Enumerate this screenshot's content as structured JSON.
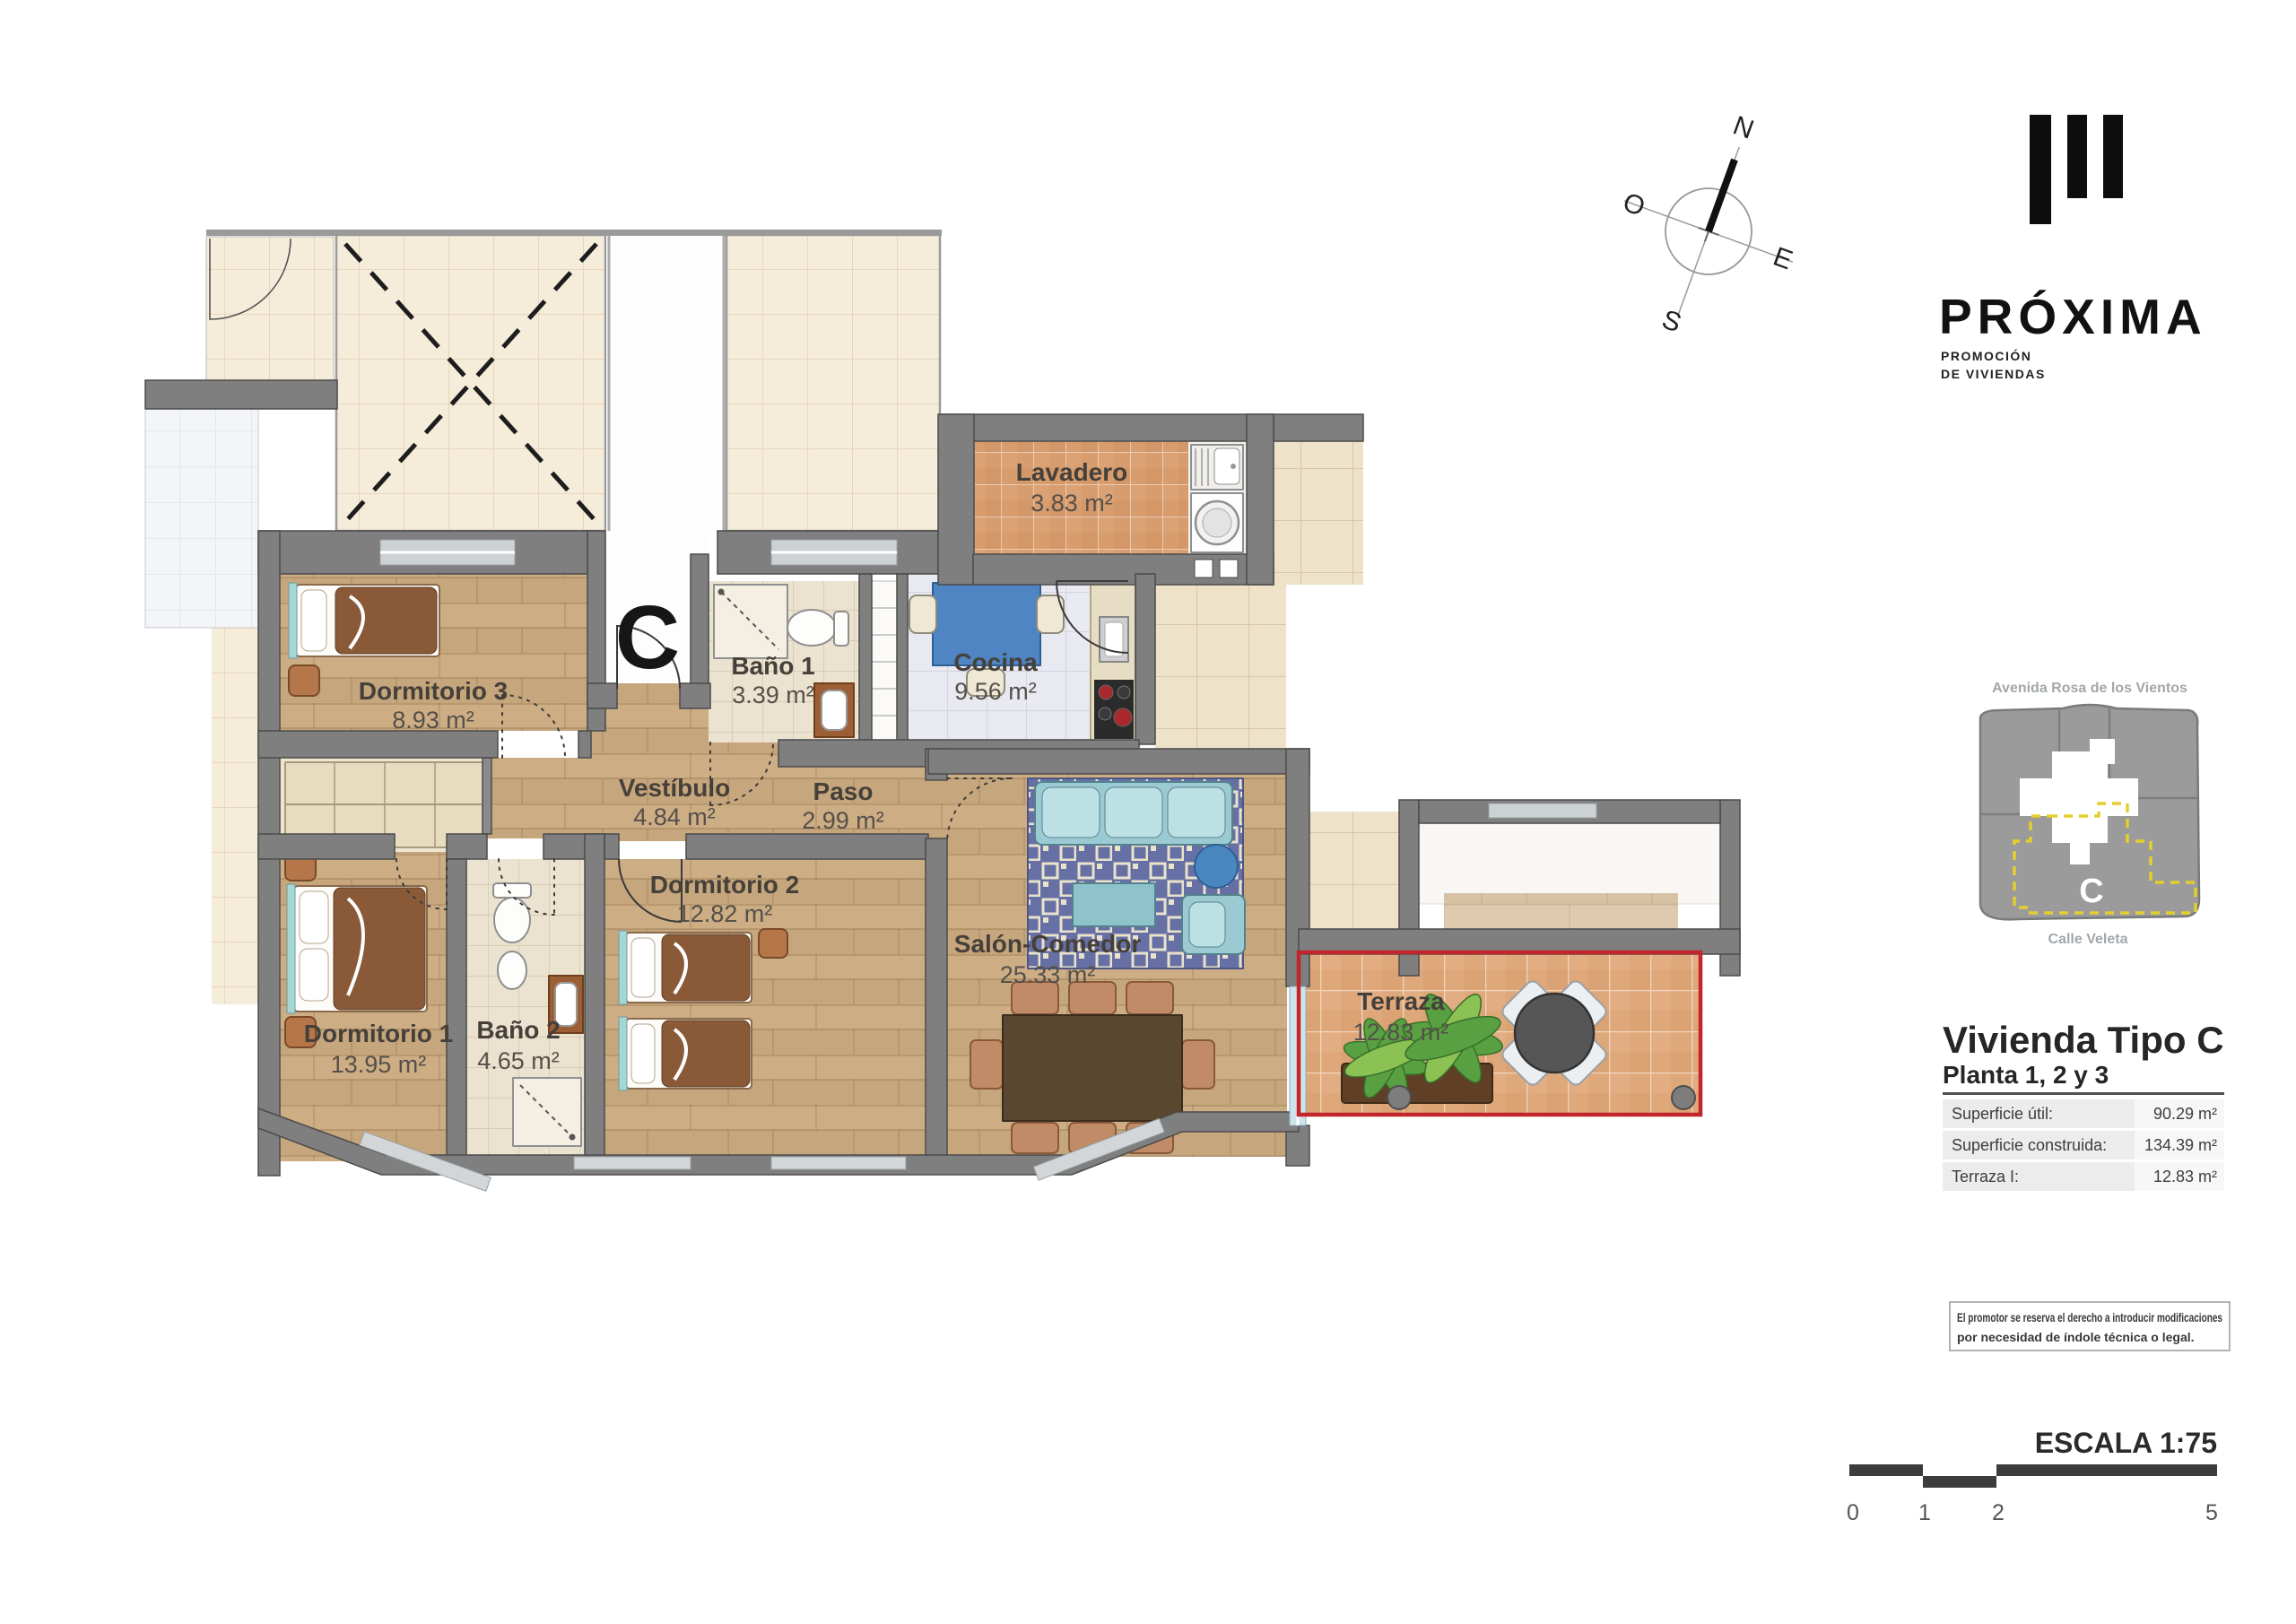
{
  "plan": {
    "unit_letter": "C",
    "rooms": [
      {
        "name": "Dormitorio 3",
        "area": "8.93 m²"
      },
      {
        "name": "Vestíbulo",
        "area": "4.84 m²"
      },
      {
        "name": "Paso",
        "area": "2.99 m²"
      },
      {
        "name": "Baño 1",
        "area": "3.39 m²"
      },
      {
        "name": "Cocina",
        "area": "9.56 m²"
      },
      {
        "name": "Lavadero",
        "area": "3.83 m²"
      },
      {
        "name": "Dormitorio 1",
        "area": "13.95 m²"
      },
      {
        "name": "Baño 2",
        "area": "4.65 m²"
      },
      {
        "name": "Dormitorio 2",
        "area": "12.82 m²"
      },
      {
        "name": "Salón-Comedor",
        "area": "25.33 m²"
      },
      {
        "name": "Terraza",
        "area": "12.83 m²"
      }
    ]
  },
  "compass": {
    "north": "N",
    "south": "S",
    "east": "E",
    "west": "O"
  },
  "brand": {
    "name": "PRÓXIMA",
    "tagline_line1": "PROMOCIÓN",
    "tagline_line2": "DE VIVIENDAS"
  },
  "site_map": {
    "street_top": "Avenida Rosa de los Vientos",
    "street_bottom": "Calle Veleta",
    "unit_label": "C"
  },
  "info": {
    "title": "Vivienda Tipo C",
    "subtitle": "Planta 1, 2 y 3",
    "rows": [
      {
        "label": "Superficie útil:",
        "value": "90.29 m²"
      },
      {
        "label": "Superficie construida:",
        "value": "134.39 m²"
      },
      {
        "label": "Terraza I:",
        "value": "12.83 m²"
      }
    ]
  },
  "disclaimer": {
    "line1": "El promotor se reserva el derecho a introducir modificaciones",
    "line2": "por necesidad de índole técnica o legal."
  },
  "scale": {
    "label": "ESCALA 1:75",
    "ticks": [
      "0",
      "1",
      "2",
      "5"
    ]
  },
  "colors": {
    "terrace_boundary": "#c2252b",
    "wall": "#7f7f7f",
    "unit_dash": "#e3cf2e"
  }
}
